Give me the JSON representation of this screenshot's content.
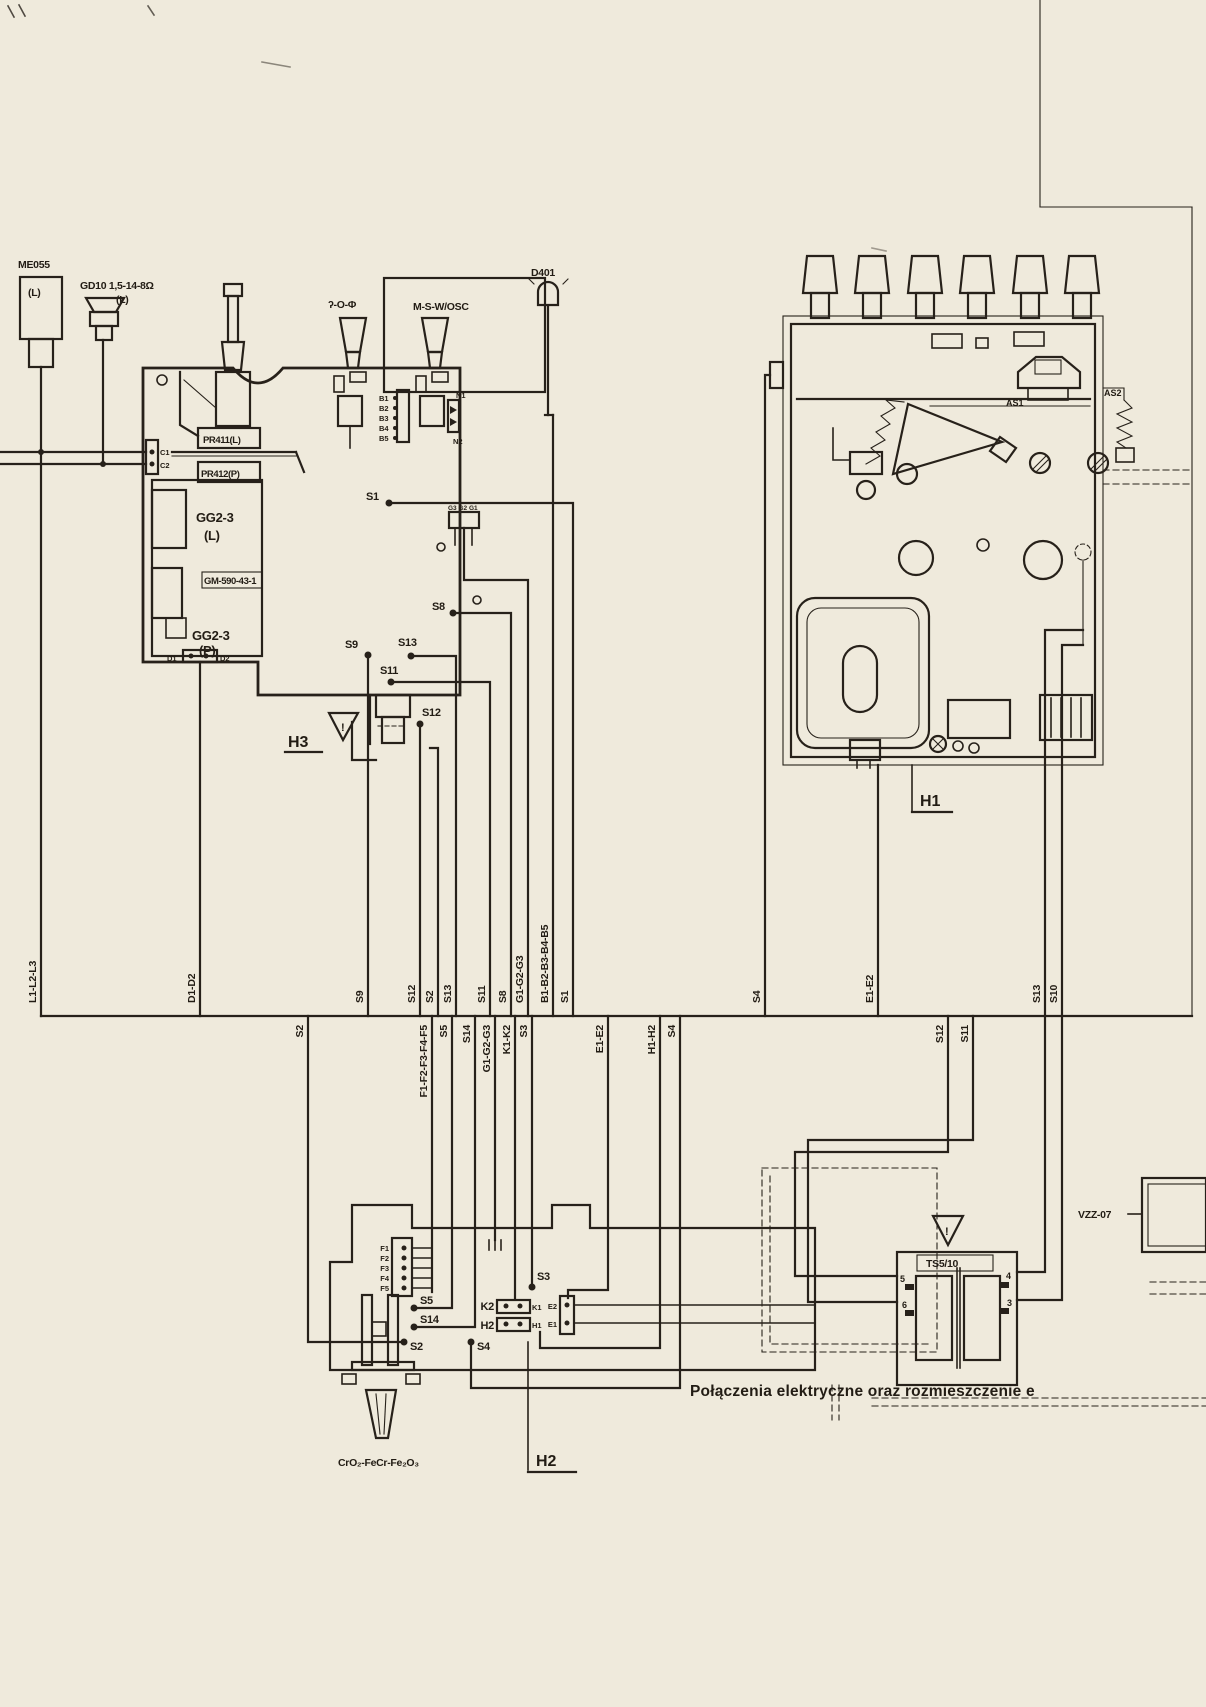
{
  "caption": "Połączenia elektryczne oraz rozmieszczenie e",
  "warning_mark": "!",
  "h3": {
    "label": "H3",
    "mic_model": "ME055",
    "mic_channel": "(L)",
    "speaker_model": "GD10 1,5-14-8Ω",
    "speaker_channel": "(L)",
    "head_record_play": "ʔ-O-Φ",
    "head_osc": "M-S-W/OSC",
    "diode": "D401",
    "pin_c1": "C1",
    "pin_c2": "C2",
    "pot_left": "PR411(L)",
    "pot_right": "PR412(P)",
    "module_left": "GG2-3",
    "module_left_channel": "(L)",
    "module_code": "GM-590-43-1",
    "module_right": "GG2-3",
    "module_right_channel": "(P)",
    "pin_d1": "D1",
    "pin_d2": "D2",
    "b_pins": [
      "B1",
      "B2",
      "B3",
      "B4",
      "B5"
    ],
    "pin_n1": "N1",
    "pin_n2": "N2",
    "point_s1": "S1",
    "g_connector": "G3 G2 G1",
    "point_s8": "S8",
    "point_s9": "S9",
    "point_s13": "S13",
    "point_s11": "S11",
    "point_s12": "S12"
  },
  "bus_top": [
    "L1-L2-L3",
    "D1-D2",
    "S9",
    "S12",
    "S2",
    "S13",
    "S11",
    "S8",
    "G1-G2-G3",
    "B1-B2-B3-B4-B5",
    "S1",
    "S4",
    "E1-E2",
    "S13",
    "S10"
  ],
  "bus_bottom": [
    "S2",
    "F1-F2-F3-F4-F5",
    "S5",
    "S14",
    "G1-G2-G3",
    "K1-K2",
    "S3",
    "E1-E2",
    "H1-H2",
    "S4",
    "S12",
    "S11"
  ],
  "h2": {
    "label": "H2",
    "f_pins": [
      "F1",
      "F2",
      "F3",
      "F4",
      "F5"
    ],
    "point_s5": "S5",
    "point_s14": "S14",
    "point_s2": "S2",
    "point_s4": "S4",
    "point_s3": "S3",
    "pin_k2": "K2",
    "pin_k1": "K1",
    "pin_h2": "H2",
    "pin_h1": "H1",
    "pin_e2": "E2",
    "pin_e1": "E1",
    "tape_formula": "CrO₂-FeCr-Fe₂O₃"
  },
  "h1": {
    "label": "H1",
    "as1": "AS1",
    "as2": "AS2"
  },
  "transformer": {
    "name": "TS5/10",
    "pin_5": "5",
    "pin_4": "4",
    "pin_6": "6",
    "pin_3": "3"
  },
  "socket_model": "VZZ-07"
}
